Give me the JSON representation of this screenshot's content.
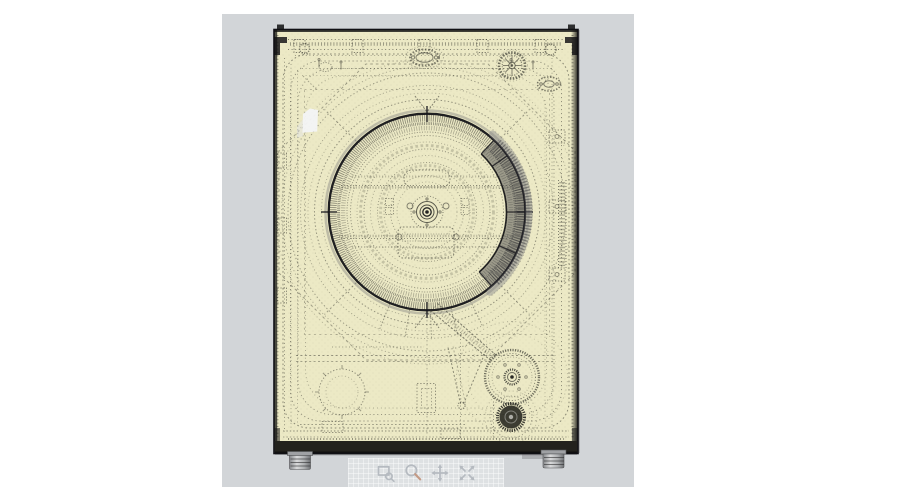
{
  "app": {
    "name": "3d-model-viewport",
    "description": "Semi-transparent technical render of a washing machine rear view displayed in a gray viewer panel with view-navigation tools"
  },
  "viewport": {
    "model_name": "washing-machine-rear-transparent-view"
  },
  "colors": {
    "page_bg": "#ffffff",
    "panel_bg": "#d2d5d8",
    "toolbar_bg": "#dee1e3",
    "icon": "#b5bac0",
    "magnifier_handle": "#c49a85",
    "model_body": "#ece9c5",
    "model_line": "#3c3c33",
    "model_outline": "#17171a",
    "base_band": "#23221d",
    "foot_metal": "#a8aaad",
    "label_sticker": "#f3f4f6"
  },
  "toolbar": {
    "tools": [
      {
        "id": "zoom-window",
        "label": "Zoom Window"
      },
      {
        "id": "zoom",
        "label": "Zoom"
      },
      {
        "id": "pan",
        "label": "Pan"
      },
      {
        "id": "zoom-extents",
        "label": "Zoom Extents"
      }
    ]
  }
}
